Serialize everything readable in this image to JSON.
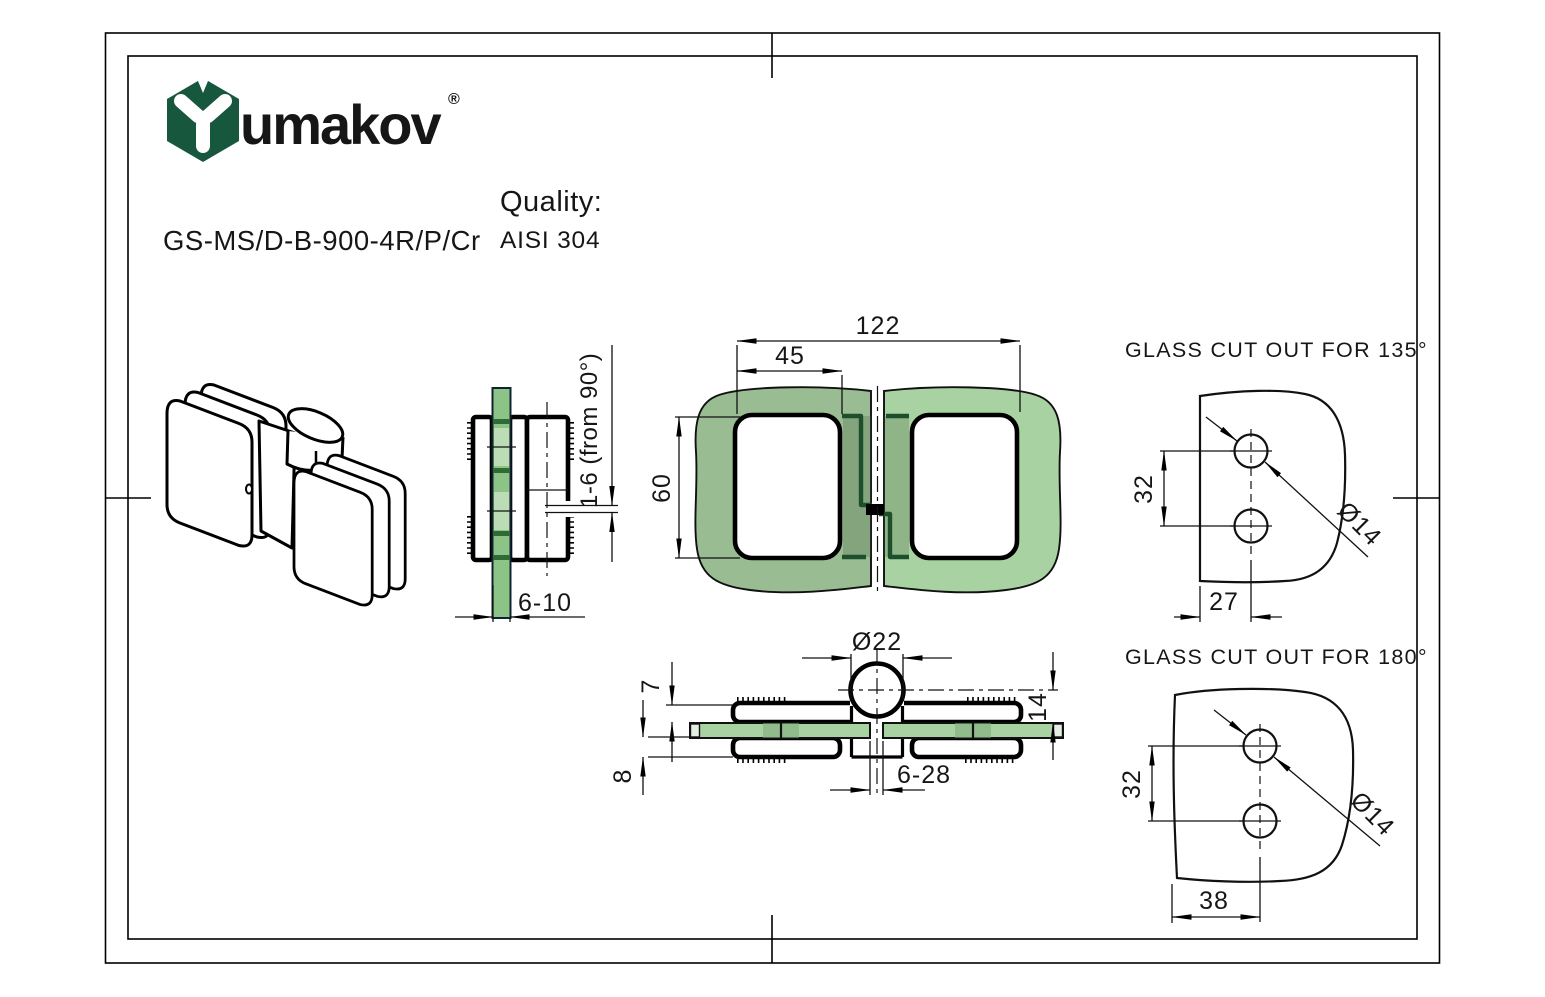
{
  "brand": {
    "name": "umakov",
    "registered_mark": "®"
  },
  "product": {
    "code": "GS-MS/D-B-900-4R/P/Cr",
    "quality_label": "Quality:",
    "quality_value": "AISI 304"
  },
  "views": {
    "front": {
      "dim_overall_width": "122",
      "dim_hinge_offset": "45",
      "dim_plate_height": "60"
    },
    "side": {
      "dim_adjustment": "1-6 (from 90°)",
      "dim_glass_thickness": "6-10"
    },
    "section": {
      "dim_knob_diameter": "Ø22",
      "dim_plate_thickness_top": "7",
      "dim_axis_to_glass": "14",
      "dim_plate_thickness_bottom": "8",
      "dim_glass_gap": "6-28"
    },
    "cutout_135": {
      "title": "GLASS CUT OUT FOR 135°",
      "dim_hole_spacing": "32",
      "dim_edge_distance": "27",
      "dim_hole_diameter": "Ø14"
    },
    "cutout_180": {
      "title": "GLASS CUT OUT FOR 180°",
      "dim_hole_spacing": "32",
      "dim_edge_distance": "38",
      "dim_hole_diameter": "Ø14"
    }
  },
  "colors": {
    "brand_green": "#17573e",
    "glass_light": "#a9d2a2",
    "glass_sage": "#9abc93",
    "glass_section": "#8cc386",
    "glass_window": "#bcdcb6",
    "glass_band": "#2f6b36",
    "glass_edge_dark": "#1d4f2c",
    "line_black": "#111111"
  }
}
